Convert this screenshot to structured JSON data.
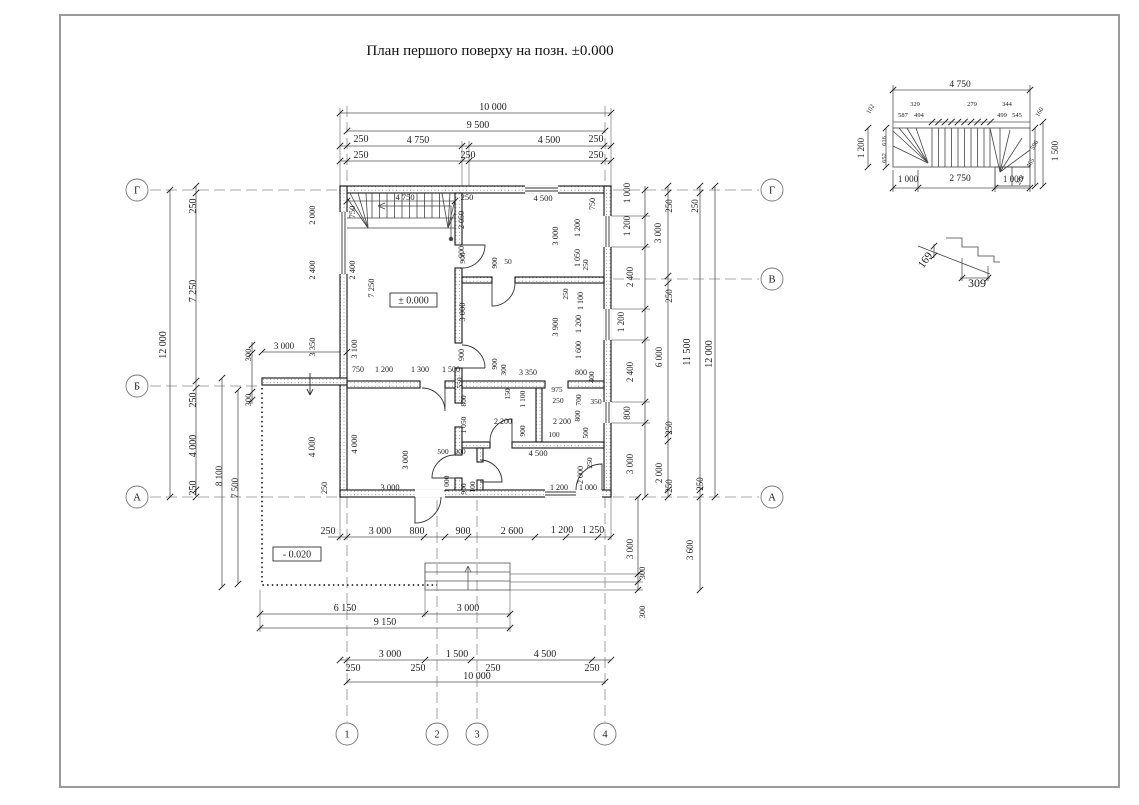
{
  "title": "План першого поверху на позн. ±0.000",
  "plan": {
    "level_label": "± 0.000",
    "terrace_level_label": "- 0.020"
  },
  "axes": {
    "row_labels": [
      "Г",
      "В",
      "Б",
      "А"
    ],
    "column_labels": [
      "1",
      "2",
      "3",
      "4"
    ]
  },
  "axis_bubbles": [
    {
      "label": "Г",
      "x": 137,
      "y": 190
    },
    {
      "label": "Б",
      "x": 137,
      "y": 386
    },
    {
      "label": "А",
      "x": 137,
      "y": 497
    },
    {
      "label": "Г",
      "x": 772,
      "y": 190
    },
    {
      "label": "В",
      "x": 772,
      "y": 279
    },
    {
      "label": "А",
      "x": 772,
      "y": 497
    },
    {
      "label": "1",
      "x": 347,
      "y": 734
    },
    {
      "label": "2",
      "x": 437,
      "y": 734
    },
    {
      "label": "3",
      "x": 477,
      "y": 734
    },
    {
      "label": "4",
      "x": 605,
      "y": 734
    }
  ],
  "dimension_labels": [
    [
      "10 000",
      493,
      110,
      0,
      10
    ],
    [
      "9 500",
      478,
      128,
      0,
      10
    ],
    [
      "250",
      361,
      142,
      0,
      10
    ],
    [
      "4 750",
      418,
      143,
      0,
      10
    ],
    [
      "4 500",
      549,
      143,
      0,
      10
    ],
    [
      "250",
      596,
      142,
      0,
      10
    ],
    [
      "250",
      361,
      158,
      0,
      10
    ],
    [
      "250",
      468,
      158,
      0,
      10
    ],
    [
      "250",
      596,
      158,
      0,
      10
    ],
    [
      "250",
      328,
      534,
      0,
      10
    ],
    [
      "3 000",
      380,
      534,
      0,
      10
    ],
    [
      "800",
      417,
      534,
      0,
      10
    ],
    [
      "900",
      463,
      534,
      0,
      10
    ],
    [
      "2 600",
      512,
      534,
      0,
      10
    ],
    [
      "1 200",
      562,
      533,
      0,
      10
    ],
    [
      "1 250",
      593,
      533,
      0,
      10
    ],
    [
      "6 150",
      345,
      611,
      0,
      10
    ],
    [
      "3 000",
      468,
      611,
      0,
      10
    ],
    [
      "9 150",
      385,
      625,
      0,
      10
    ],
    [
      "3 000",
      390,
      657,
      0,
      10
    ],
    [
      "1 500",
      457,
      657,
      0,
      10
    ],
    [
      "4 500",
      545,
      657,
      0,
      10
    ],
    [
      "250",
      353,
      671,
      0,
      10
    ],
    [
      "250",
      418,
      671,
      0,
      10
    ],
    [
      "250",
      493,
      671,
      0,
      10
    ],
    [
      "250",
      592,
      671,
      0,
      10
    ],
    [
      "10 000",
      477,
      679,
      0,
      10
    ],
    [
      "12 000",
      166,
      345,
      -90,
      10
    ],
    [
      "250",
      196,
      206,
      -90,
      10
    ],
    [
      "7 250",
      196,
      291,
      -90,
      10
    ],
    [
      "250",
      196,
      400,
      -90,
      10
    ],
    [
      "4 000",
      196,
      446,
      -90,
      10
    ],
    [
      "250",
      196,
      488,
      -90,
      10
    ],
    [
      "8 100",
      222,
      476,
      -90,
      9
    ],
    [
      "7 500",
      238,
      488,
      -90,
      9
    ],
    [
      "300",
      251,
      355,
      -90,
      8.5
    ],
    [
      "3 000",
      284,
      349,
      0,
      9
    ],
    [
      "300",
      251,
      400,
      -90,
      8.5
    ],
    [
      "4 000",
      315,
      447,
      -90,
      9
    ],
    [
      "250",
      327,
      488,
      -90,
      8
    ],
    [
      "2 000",
      315,
      215,
      -90,
      8.5
    ],
    [
      "2 400",
      315,
      270,
      -90,
      8.5
    ],
    [
      "3 350",
      315,
      347,
      -90,
      8.5
    ],
    [
      "750",
      355,
      212,
      -90,
      8.5
    ],
    [
      "2 400",
      355,
      270,
      -90,
      8.5
    ],
    [
      "3 100",
      357,
      349,
      -90,
      8.5
    ],
    [
      "7 250",
      374,
      288,
      -90,
      8.5
    ],
    [
      "4 750",
      405,
      200,
      0,
      8.5
    ],
    [
      "250",
      467,
      200,
      0,
      8.5
    ],
    [
      "2 050",
      464,
      220,
      -90,
      8
    ],
    [
      "900",
      464,
      252,
      -90,
      8
    ],
    [
      "3 000",
      465,
      312,
      -90,
      8.5
    ],
    [
      "900",
      464,
      355,
      -90,
      8
    ],
    [
      "750",
      358,
      372,
      0,
      8
    ],
    [
      "1 200",
      384,
      372,
      0,
      8
    ],
    [
      "1 300",
      420,
      372,
      0,
      8
    ],
    [
      "1 500",
      451,
      372,
      0,
      8
    ],
    [
      "550",
      462,
      383,
      -90,
      7.5
    ],
    [
      "900",
      497,
      364,
      -90,
      7.5
    ],
    [
      "300",
      506,
      370,
      -90,
      7.5
    ],
    [
      "800",
      466,
      401,
      -90,
      7.5
    ],
    [
      "1 050",
      466,
      425,
      -90,
      7.5
    ],
    [
      "150",
      510,
      394,
      -90,
      7.5
    ],
    [
      "975",
      557,
      392,
      0,
      7.5
    ],
    [
      "250",
      558,
      403,
      0,
      7.5
    ],
    [
      "1 100",
      525,
      399,
      -90,
      7.5
    ],
    [
      "700",
      581,
      400,
      -90,
      7.5
    ],
    [
      "350",
      596,
      404,
      0,
      7.5
    ],
    [
      "2 200",
      503,
      424,
      0,
      8
    ],
    [
      "900",
      525,
      431,
      -90,
      7.5
    ],
    [
      "2 200",
      562,
      424,
      0,
      8
    ],
    [
      "100",
      554,
      437,
      0,
      7.5
    ],
    [
      "800",
      580,
      416,
      -90,
      7.5
    ],
    [
      "500",
      588,
      433,
      -90,
      7.5
    ],
    [
      "500",
      443,
      454,
      0,
      7.5
    ],
    [
      "900",
      460,
      454,
      0,
      7.5
    ],
    [
      "4 500",
      538,
      456,
      0,
      8.5
    ],
    [
      "250",
      592,
      463,
      -90,
      7.5
    ],
    [
      "3 000",
      408,
      460,
      -90,
      8.5
    ],
    [
      "3 000",
      390,
      490,
      0,
      8.5
    ],
    [
      "4 000",
      357,
      444,
      -90,
      8.5
    ],
    [
      "1 000",
      449,
      484,
      -90,
      7.5
    ],
    [
      "900",
      466,
      489,
      -90,
      7.5
    ],
    [
      "100",
      475,
      487,
      -90,
      7.5
    ],
    [
      "2 000",
      583,
      475,
      -90,
      8
    ],
    [
      "1 200",
      559,
      490,
      0,
      8
    ],
    [
      "1 000",
      588,
      490,
      0,
      8
    ],
    [
      "3 350",
      528,
      375,
      0,
      8
    ],
    [
      "800",
      581,
      375,
      0,
      8
    ],
    [
      "400",
      594,
      377,
      -90,
      7.5
    ],
    [
      "4 500",
      543,
      201,
      0,
      8.5
    ],
    [
      "750",
      595,
      204,
      -90,
      8
    ],
    [
      "3 000",
      558,
      236,
      -90,
      8.5
    ],
    [
      "1 200",
      580,
      228,
      -90,
      8
    ],
    [
      "1 050",
      580,
      258,
      -90,
      8
    ],
    [
      "250",
      588,
      265,
      -90,
      7.5
    ],
    [
      "50",
      508,
      264,
      0,
      7.5
    ],
    [
      "900",
      465,
      258,
      -90,
      7.5
    ],
    [
      "900",
      497,
      263,
      -90,
      7.5
    ],
    [
      "250",
      568,
      294,
      -90,
      7.5
    ],
    [
      "3 900",
      558,
      327,
      -90,
      8.5
    ],
    [
      "1 100",
      583,
      301,
      -90,
      8
    ],
    [
      "1 200",
      581,
      324,
      -90,
      8
    ],
    [
      "1 600",
      581,
      350,
      -90,
      8
    ],
    [
      "1 000",
      630,
      193,
      -90,
      9
    ],
    [
      "1 200",
      630,
      226,
      -90,
      9
    ],
    [
      "2 400",
      633,
      277,
      -90,
      9
    ],
    [
      "1 200",
      624,
      322,
      -90,
      9
    ],
    [
      "2 400",
      633,
      372,
      -90,
      9
    ],
    [
      "800",
      630,
      413,
      -90,
      9
    ],
    [
      "3 000",
      633,
      464,
      -90,
      9
    ],
    [
      "250",
      672,
      206,
      -90,
      9
    ],
    [
      "3 000",
      661,
      233,
      -90,
      9
    ],
    [
      "250",
      672,
      296,
      -90,
      9
    ],
    [
      "6 000",
      662,
      357,
      -90,
      9
    ],
    [
      "250",
      672,
      428,
      -90,
      9
    ],
    [
      "2 000",
      662,
      473,
      -90,
      9
    ],
    [
      "250",
      672,
      486,
      -90,
      9
    ],
    [
      "250",
      698,
      206,
      -90,
      9
    ],
    [
      "11 500",
      690,
      352,
      -90,
      10
    ],
    [
      "250",
      703,
      484,
      -90,
      9
    ],
    [
      "12 000",
      712,
      354,
      -90,
      10
    ],
    [
      "3 000",
      633,
      549,
      -90,
      9
    ],
    [
      "300",
      645,
      573,
      -90,
      8.5
    ],
    [
      "300",
      645,
      612,
      -90,
      8.5
    ],
    [
      "3 600",
      693,
      550,
      -90,
      9
    ]
  ],
  "stair_detail": {
    "labels": [
      [
        "4 750",
        960,
        87,
        0,
        9.5
      ],
      [
        "329",
        915,
        106,
        0,
        6.5
      ],
      [
        "279",
        972,
        106,
        0,
        6.5
      ],
      [
        "344",
        1007,
        106,
        0,
        6.5
      ],
      [
        "587",
        903,
        117,
        0,
        6.5
      ],
      [
        "494",
        919,
        117,
        0,
        6.5
      ],
      [
        "499",
        1002,
        117,
        0,
        6.5
      ],
      [
        "545",
        1017,
        117,
        0,
        6.5
      ],
      [
        "102",
        872,
        110,
        -60,
        6.5
      ],
      [
        "1 200",
        864,
        148,
        -90,
        9
      ],
      [
        "616",
        886,
        141,
        -90,
        6.5
      ],
      [
        "652",
        886,
        158,
        -90,
        6.5
      ],
      [
        "160",
        1041,
        113,
        -60,
        6.5
      ],
      [
        "1 500",
        1058,
        151,
        -90,
        9
      ],
      [
        "596",
        1036,
        146,
        -60,
        6.5
      ],
      [
        "465",
        1032,
        164,
        -60,
        6.5
      ],
      [
        "278",
        1022,
        181,
        -60,
        6.5
      ],
      [
        "1 000",
        908,
        182,
        0,
        9
      ],
      [
        "2 750",
        960,
        181,
        0,
        9.5
      ],
      [
        "1 000",
        1013,
        182,
        0,
        9
      ]
    ]
  },
  "step_detail": {
    "labels": [
      [
        "169",
        928,
        262,
        -55,
        11
      ],
      [
        "309",
        977,
        287,
        0,
        12
      ]
    ]
  }
}
